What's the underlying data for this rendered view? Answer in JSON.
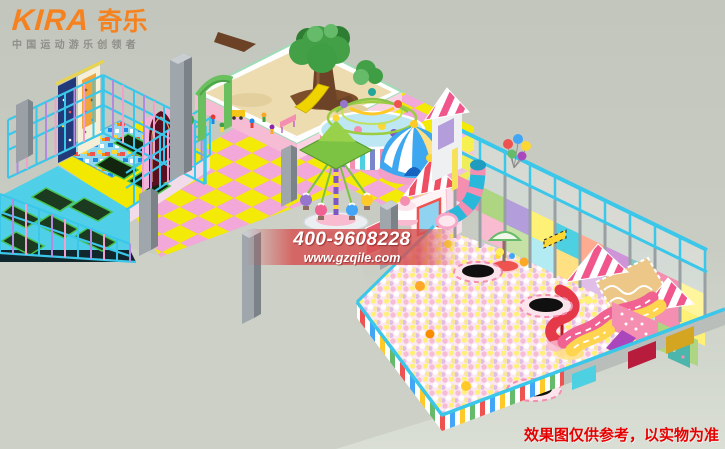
{
  "logo": {
    "brand_en": "KIRA",
    "brand_cn": "奇乐",
    "tagline": "中国运动游乐创领者"
  },
  "contact": {
    "phone": "400-9608228",
    "website": "www.gzqile.com"
  },
  "disclaimer": {
    "text": "效果图仅供参考，以实物为准"
  },
  "palette": {
    "logo_orange": "#f5821f",
    "tagline_gray": "#8f8f89",
    "banner_red": "#d65050",
    "text_white": "#ffffff",
    "disclaimer_red": "#e60000",
    "frame_cyan": "#3bc7e9",
    "post_violet": "#b48ae0",
    "post_pink": "#f0a0cc",
    "deck_yellow": "#f2e800",
    "deck_cyan": "#4fd0e8",
    "mat_dark": "#13250f",
    "mat_rim": "#46c24e",
    "foam_blue": "#92d8ec",
    "sand_tan": "#ecdcb0",
    "sandbox_pink": "#f6bcd4",
    "tree_green": "#43a047",
    "trunk_brown": "#6d4327",
    "tile_yellow": "#f3ea07",
    "tile_pink": "#f2a8d8",
    "floor_gray": "#ccd0c7",
    "pit_pink": "#fbe8f1",
    "candy_red": "#ef4f63",
    "dome_blue": "#3da8f0",
    "pillar_gray": "#a0a7ac"
  }
}
